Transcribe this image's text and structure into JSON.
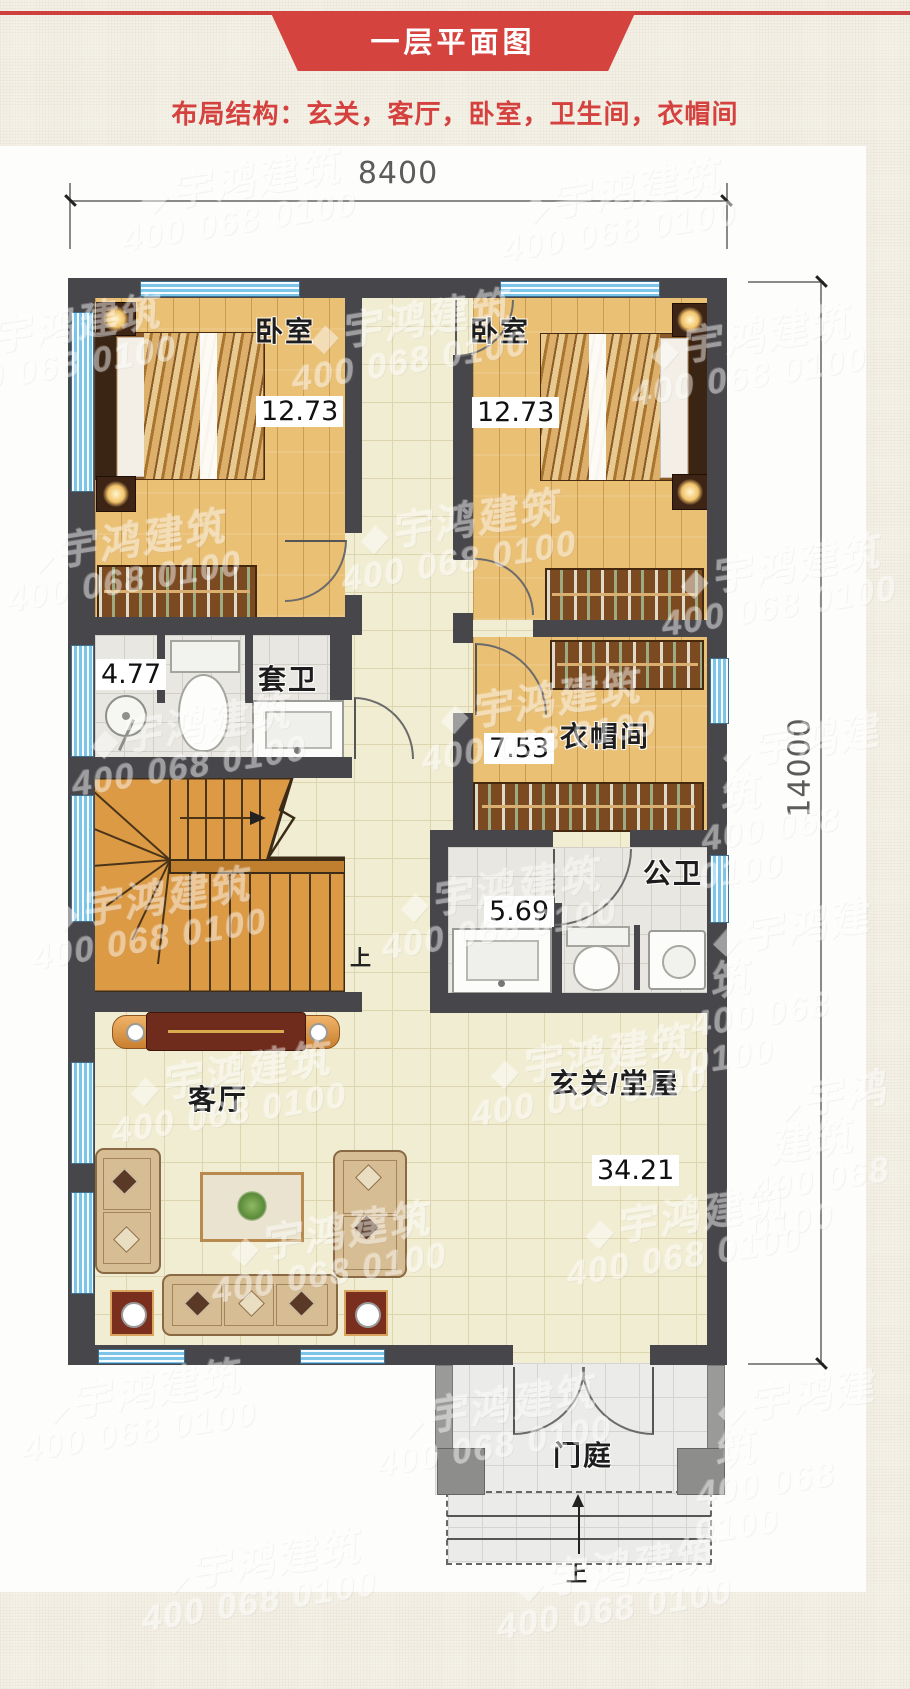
{
  "header": {
    "title": "一层平面图",
    "subtitle": "布局结构：玄关，客厅，卧室，卫生间，衣帽间"
  },
  "dimensions": {
    "top_width": "8400",
    "right_height": "14000"
  },
  "rooms": {
    "bedroom_left": {
      "label": "卧室",
      "area": "12.73"
    },
    "bedroom_right": {
      "label": "卧室",
      "area": "12.73"
    },
    "ensuite_bath": {
      "label": "套卫",
      "area": "4.77"
    },
    "cloakroom": {
      "label": "衣帽间",
      "area": "7.53"
    },
    "public_bath": {
      "label": "公卫",
      "area": "5.69"
    },
    "living_room": {
      "label": "客厅"
    },
    "entry_hall": {
      "label": "玄关/堂屋",
      "area": "34.21"
    },
    "porch": {
      "label": "门庭"
    }
  },
  "stairs": {
    "direction_label": "上"
  },
  "entry_steps": {
    "direction_label": "上"
  },
  "watermark": {
    "logo": "◆",
    "brand": "宇鸿建筑",
    "phone": "400 068 0100"
  },
  "colors": {
    "accent_red": "#d5433f",
    "wall": "#47474b",
    "window_blue": "#7cc4e8",
    "wood_floor": "#eac075",
    "tile_cream": "#f1edd3",
    "stair_wood": "#dc9a45"
  }
}
